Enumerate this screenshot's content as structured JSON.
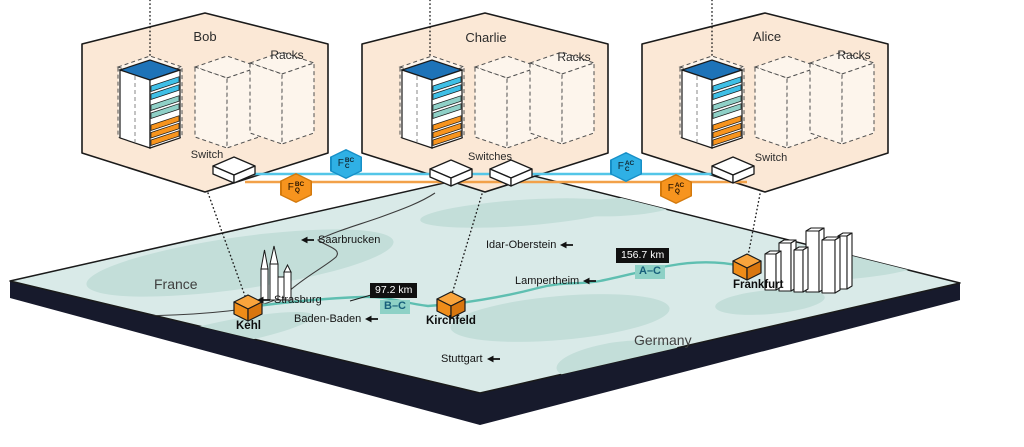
{
  "nodes": [
    {
      "name": "Bob",
      "racks": "Racks",
      "switch": "Switch"
    },
    {
      "name": "Charlie",
      "racks": "Racks",
      "switch": "Switches"
    },
    {
      "name": "Alice",
      "racks": "Racks",
      "switch": "Switch"
    }
  ],
  "fiber_badges": [
    {
      "base": "F",
      "sup": "BC",
      "sub": "C",
      "type": "classical"
    },
    {
      "base": "F",
      "sup": "BC",
      "sub": "Q",
      "type": "quantum"
    },
    {
      "base": "F",
      "sup": "AC",
      "sub": "C",
      "type": "classical"
    },
    {
      "base": "F",
      "sup": "AC",
      "sub": "Q",
      "type": "quantum"
    }
  ],
  "map": {
    "countries": [
      "France",
      "Germany"
    ],
    "cities": [
      {
        "name": "Saarbrucken",
        "arrow_side": "before"
      },
      {
        "name": "Idar-Oberstein",
        "arrow_side": "after"
      },
      {
        "name": "Strasburg",
        "arrow_side": "before"
      },
      {
        "name": "Baden-Baden",
        "arrow_side": "after"
      },
      {
        "name": "Lampertheim",
        "arrow_side": "after"
      },
      {
        "name": "Stuttgart",
        "arrow_side": "after"
      }
    ],
    "stations": [
      "Kehl",
      "Kirchfeld",
      "Frankfurt"
    ],
    "links": [
      {
        "distance": "97.2 km",
        "route": "B–C"
      },
      {
        "distance": "156.7 km",
        "route": "A–C"
      }
    ]
  },
  "colors": {
    "classical_fiber": "#29abe2",
    "quantum_fiber": "#f7941e",
    "room_fill": "#fbe8d6",
    "map_base": "#d9eae8",
    "map_patch": "#c3ded9",
    "map_slab": "#171a2c",
    "route_line": "#5fbfb1",
    "distance_badge_bg": "#101010",
    "route_badge_bg": "#8ed1c6"
  }
}
